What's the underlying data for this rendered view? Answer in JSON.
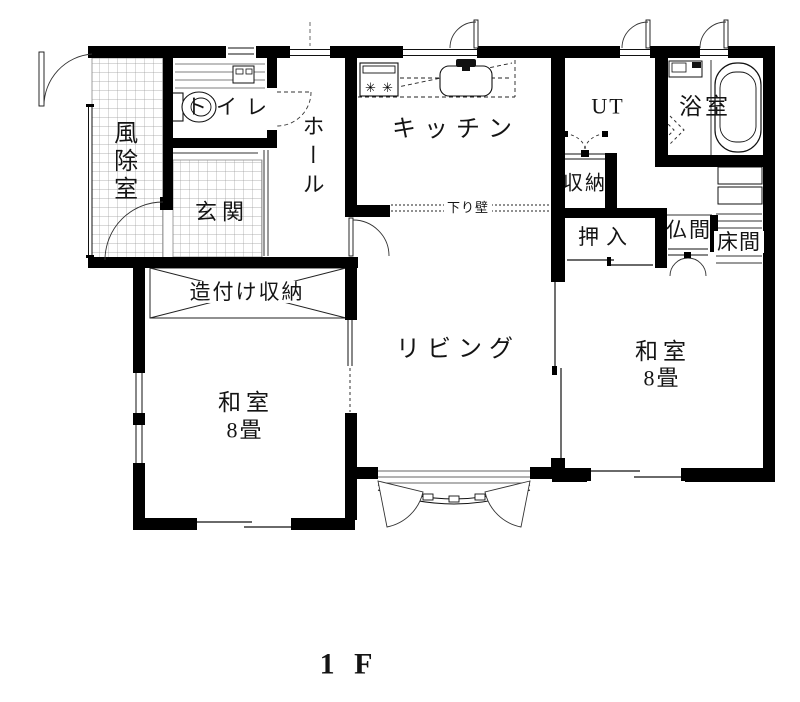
{
  "floor_plan": {
    "floor_label": "1 F",
    "rooms": {
      "vestibule": "風除室",
      "toilet": "トイレ",
      "entrance": "玄関",
      "hall": "ホール",
      "kitchen": "キッチン",
      "utility": "UT",
      "bathroom": "浴室",
      "storage": "収納",
      "closet": "押入",
      "buddhist_altar_room": "仏間",
      "alcove": "床間",
      "built_in_storage": "造付け収納",
      "living": "リビング",
      "dropped_wall": "下り壁",
      "japanese_room_left": {
        "name": "和室",
        "size": "8畳"
      },
      "japanese_room_right": {
        "name": "和室",
        "size": "8畳"
      }
    },
    "icons": {
      "stove_burner": "✳"
    },
    "colors": {
      "wall": "#000000",
      "line": "#1a1a1a",
      "tile_line": "#9a9a9a",
      "background": "#ffffff"
    }
  }
}
